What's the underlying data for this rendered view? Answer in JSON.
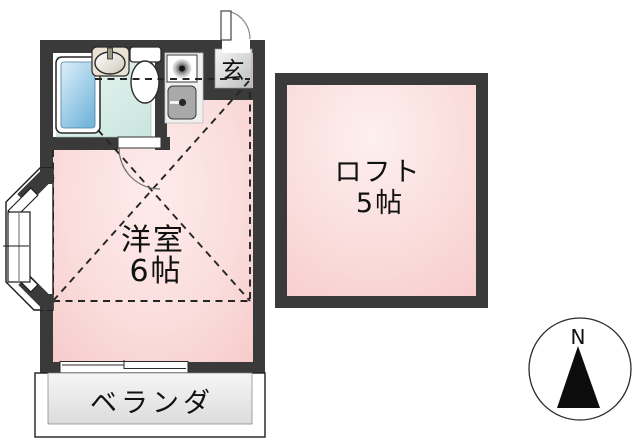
{
  "floorplan": {
    "type": "apartment-floor-plan",
    "rooms": {
      "living": {
        "name_line": "洋室",
        "size_line": "6帖"
      },
      "loft": {
        "name_line": "ロフト",
        "size_line": "5帖"
      },
      "entrance": {
        "label": "玄"
      },
      "veranda": {
        "label": "ベランダ"
      }
    },
    "compass": {
      "north_label": "N"
    },
    "fixtures": [
      "bathtub",
      "wash-basin",
      "toilet",
      "stove-burner",
      "kitchen-sink",
      "entrance-door",
      "bathroom-door",
      "bay-window",
      "sliding-window"
    ],
    "colors": {
      "wall": "#3a3a3a",
      "room_pink": "#f8d1d0",
      "room_pink_light": "#fdeceb",
      "bathroom_teal": "#d9ece7",
      "bathtub_blue": "#7ebbde",
      "entrance_gray": "#cfcfcf",
      "veranda_gray": "#e9e9e9",
      "line_black": "#1a1a1a"
    }
  }
}
